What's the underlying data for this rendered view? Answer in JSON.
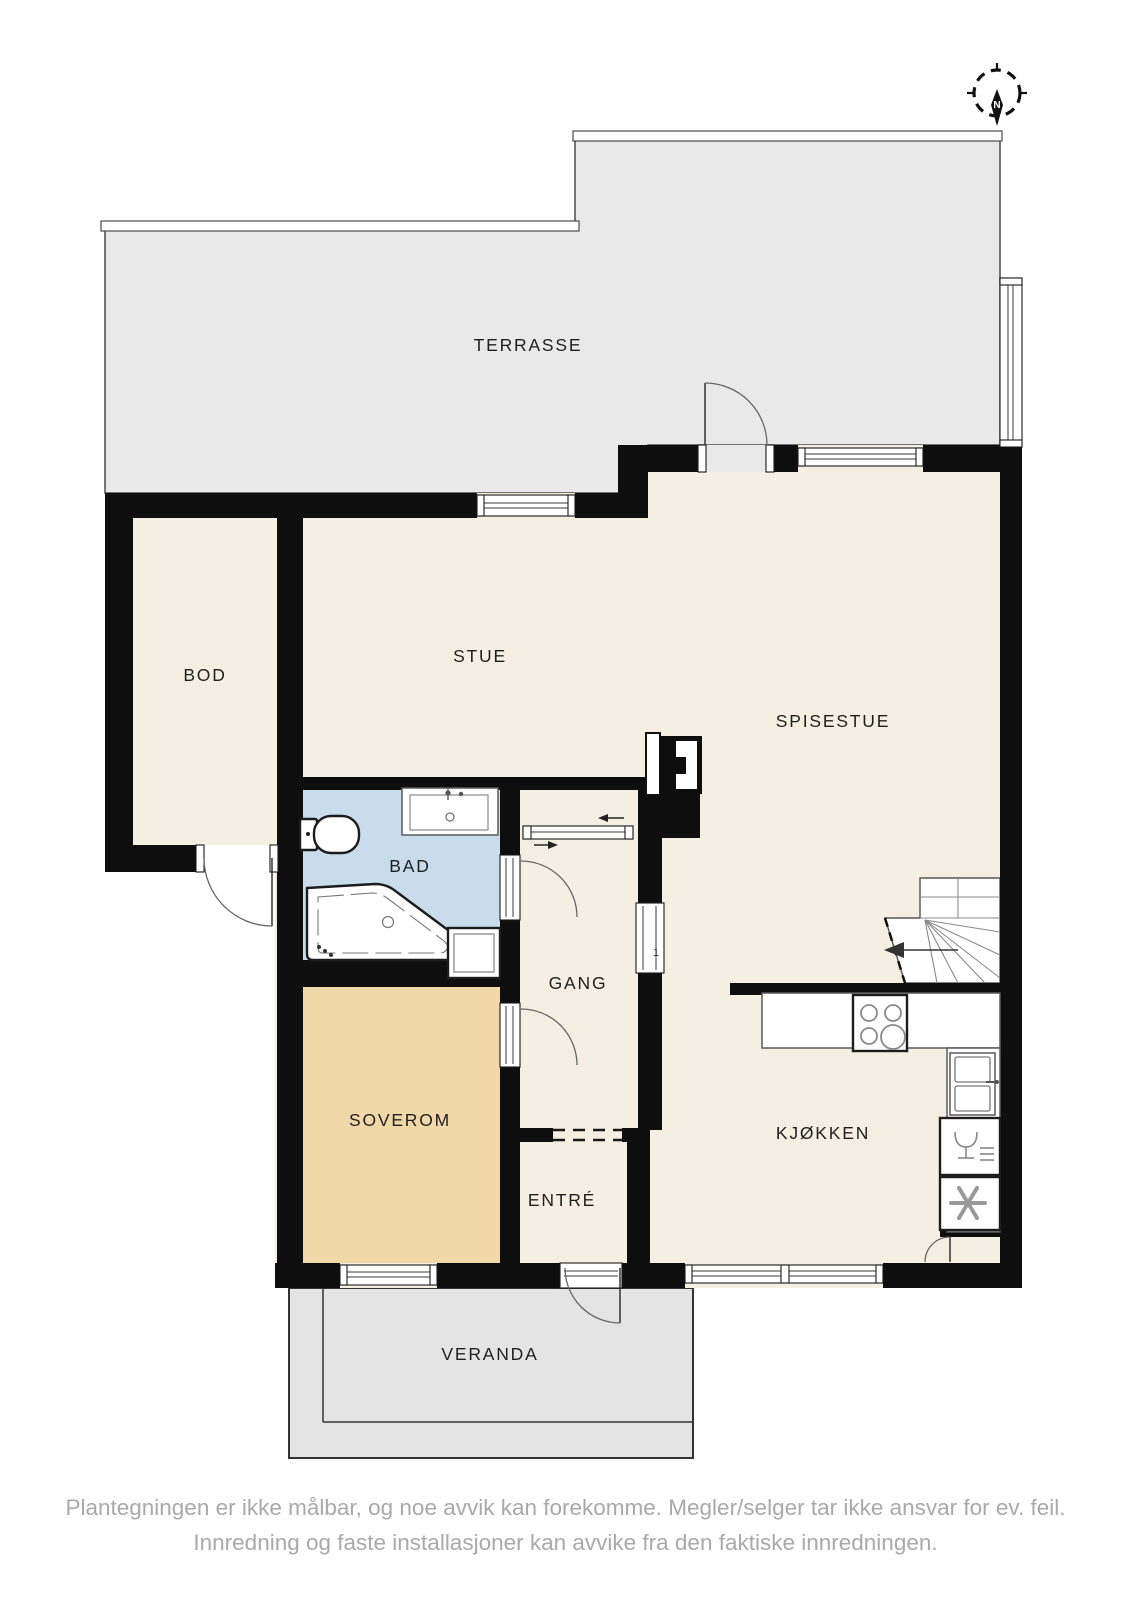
{
  "plan": {
    "rooms": {
      "terrasse": "TERRASSE",
      "bod": "BOD",
      "stue": "STUE",
      "spisestue": "SPISESTUE",
      "bad": "BAD",
      "gang": "GANG",
      "soverom": "SOVEROM",
      "entre": "ENTRÉ",
      "kjokken": "KJØKKEN",
      "veranda": "VERANDA"
    },
    "compass": {
      "north_label": "N"
    },
    "annotations": {
      "door_number": "1"
    },
    "colors": {
      "wall": "#0e0e0e",
      "floor": "#f4efe2",
      "bathroom_floor": "#c8dcea",
      "bedroom_floor": "#f2d8a8",
      "terrace_floor": "#e9e9e9",
      "veranda_floor": "#e4e4e4",
      "fixture": "#ffffff",
      "label_text": "#1f1f1f",
      "disclaimer_text": "#a9a9a9"
    },
    "disclaimer": {
      "line1": "Plantegningen er ikke målbar, og noe avvik kan forekomme. Megler/selger tar ikke ansvar for ev. feil.",
      "line2": "Innredning og faste installasjoner kan avvike fra den faktiske innredningen."
    }
  }
}
